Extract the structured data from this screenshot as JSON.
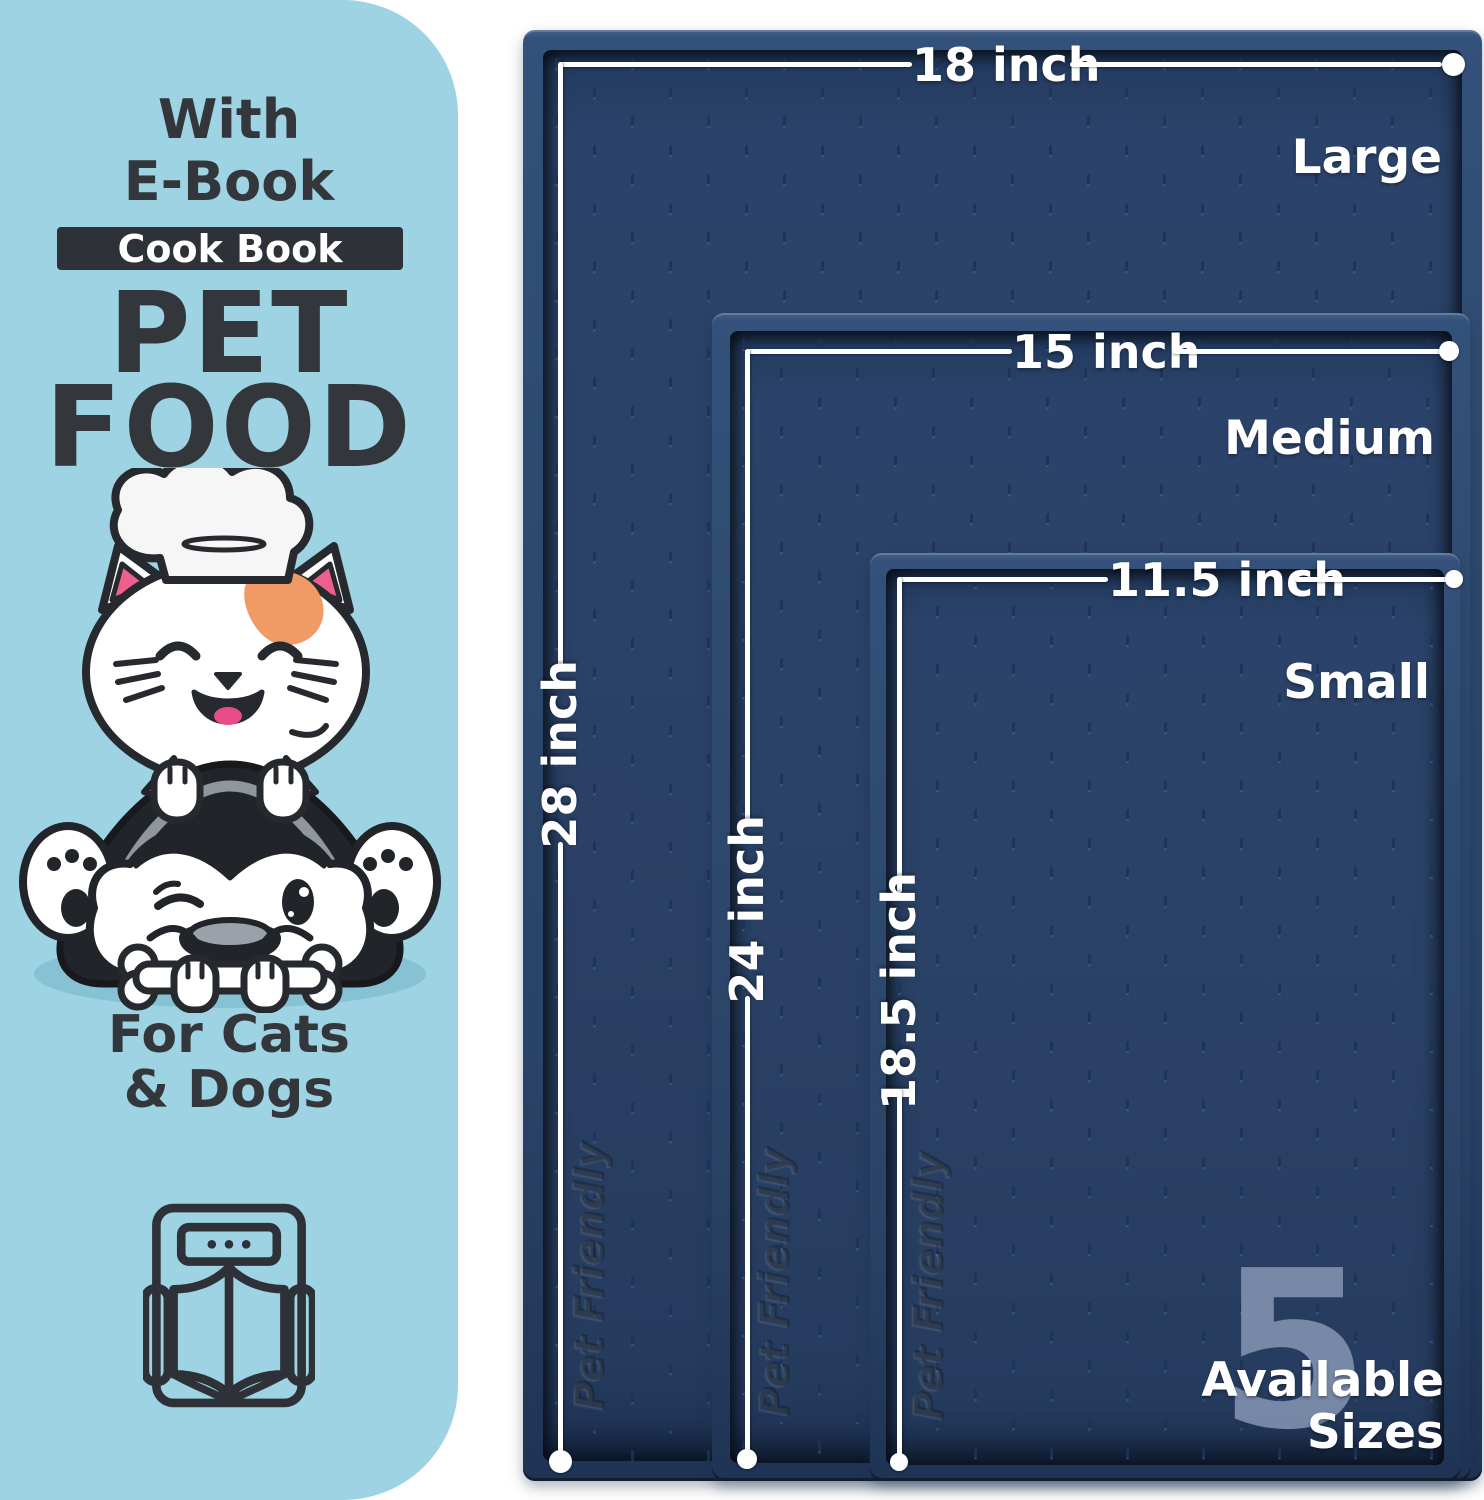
{
  "left_panel": {
    "eyebrow_line1": "With",
    "eyebrow_line2": "E-Book",
    "badge_label": "Cook Book",
    "title_line1": "PET",
    "title_line2": "FOOD",
    "audience_line1": "For Cats",
    "audience_line2": "& Dogs",
    "illustration": "cat-chef-on-husky-with-bone",
    "icon": "ebook-tablet-open-book-icon"
  },
  "mats": [
    {
      "size_name": "Large",
      "width_label": "18 inch",
      "height_label": "28 inch",
      "embossed_text": "Pet Friendly"
    },
    {
      "size_name": "Medium",
      "width_label": "15 inch",
      "height_label": "24 inch",
      "embossed_text": "Pet Friendly"
    },
    {
      "size_name": "Small",
      "width_label": "11.5 inch",
      "height_label": "18.5 inch",
      "embossed_text": "Pet Friendly"
    }
  ],
  "sizes_callout": {
    "count": "5",
    "word1": "Available",
    "word2": "Sizes"
  },
  "colors": {
    "panel_bg": "#9dd3e2",
    "ink_dark": "#33363b",
    "badge_bg": "#2e3138",
    "mat_face": "#2a4165",
    "mat_rim": "#33517a",
    "dimension_white": "#ffffff",
    "count_tint": "#8d9cba",
    "accent_orange": "#f09a66",
    "accent_pink": "#ee5f8d",
    "husky_black": "#212429"
  }
}
